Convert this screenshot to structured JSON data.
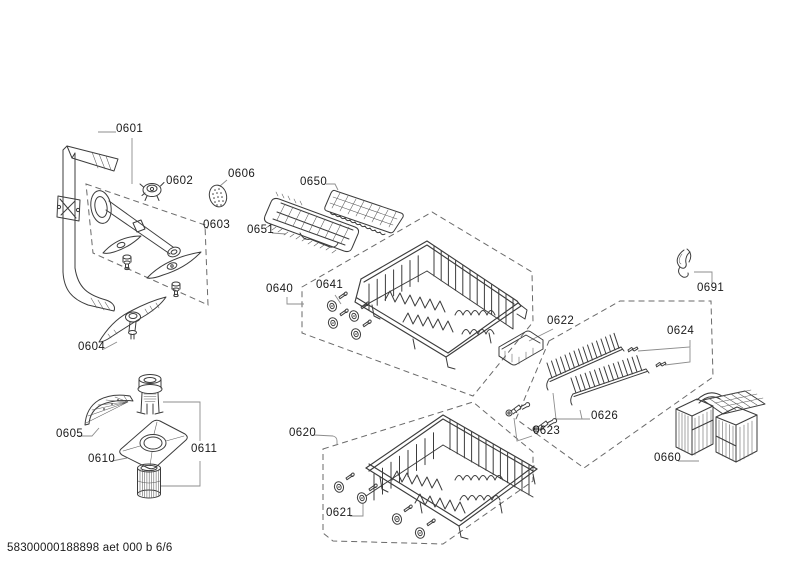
{
  "document": {
    "footer_code": "58300000188898 aet 000 b 6/6"
  },
  "colors": {
    "background": "#ffffff",
    "part_line": "#3c3c3c",
    "dashed_group_box": "#6a6a6a",
    "leader_line": "#8c8c8c",
    "text": "#1a1a1a"
  },
  "callouts": {
    "c0601": "0601",
    "c0602": "0602",
    "c0603": "0603",
    "c0604": "0604",
    "c0605": "0605",
    "c0606": "0606",
    "c0610": "0610",
    "c0611": "0611",
    "c0620": "0620",
    "c0621": "0621",
    "c0622": "0622",
    "c0623": "0623",
    "c0624": "0624",
    "c0626": "0626",
    "c0640": "0640",
    "c0641": "0641",
    "c0650": "0650",
    "c0651": "0651",
    "c0660": "0660",
    "c0691": "0691"
  }
}
